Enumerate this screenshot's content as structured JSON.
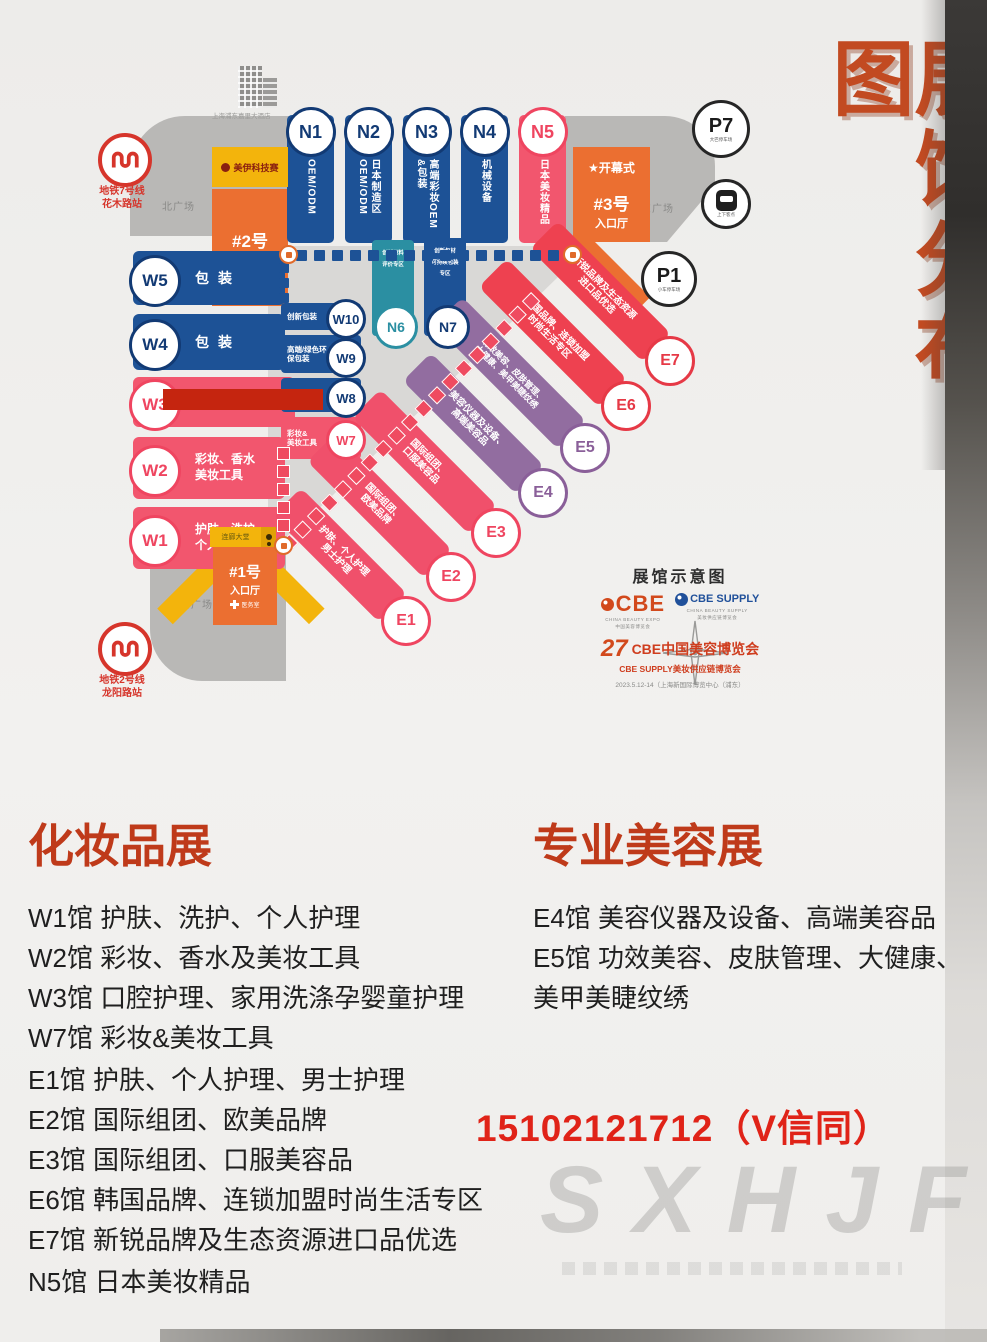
{
  "title": "展馆分布图",
  "colors": {
    "accent_red": "#c24a21",
    "blue": "#1d5296",
    "pink": "#f2566e",
    "red": "#ee4150",
    "purple": "#926da0",
    "orange": "#eb6f31",
    "yellow": "#f3b40c",
    "teal": "#2b8fa2",
    "phone_red": "#e02318",
    "metro_red": "#d6352b"
  },
  "map": {
    "building_caption": "上海浦东嘉里大酒店",
    "metro7": {
      "line": "地铁7号线",
      "station": "花木路站"
    },
    "metro2": {
      "line": "地铁2号线",
      "station": "龙阳路站"
    },
    "plaza_north": "北广场",
    "plaza_east": "东广场",
    "plaza_south": "南广场",
    "science_box": "美伊科技赛",
    "walkway": "连廊大堂",
    "entrance2": {
      "no": "#2号",
      "hall": "入口厅"
    },
    "entrance3": {
      "no": "#3号",
      "hall": "入口厅",
      "ceremony": "★开幕式"
    },
    "entrance1": {
      "no": "#1号",
      "hall": "入口厅",
      "medical": "医务室"
    },
    "p7": {
      "label": "P7",
      "caption": "大巴停车场"
    },
    "p1": {
      "label": "P1",
      "caption": "小车停车场"
    },
    "taxi_caption": "上下客点",
    "n_halls": [
      {
        "id": "N1",
        "col1": "OEM/ODM",
        "col2": ""
      },
      {
        "id": "N2",
        "col1": "日本制造区",
        "col2": "OEM/ODM"
      },
      {
        "id": "N3",
        "col1": "高端彩妆OEM",
        "col2": "&包装"
      },
      {
        "id": "N4",
        "col1": "机械设备",
        "col2": ""
      },
      {
        "id": "N5",
        "col1": "日本美妆精品",
        "col2": ""
      }
    ],
    "n6": {
      "id": "N6",
      "line1": "创新原料",
      "line2": "评价专区",
      "line3": ""
    },
    "n7": {
      "id": "N7",
      "line1": "创新包材",
      "line2": "可持续包装",
      "line3": "专区"
    },
    "w_bars": [
      {
        "id": "W5",
        "text": "包装"
      },
      {
        "id": "W4",
        "text": "包装"
      },
      {
        "id": "W3",
        "text": "口腔护理、家用洗涤"
      },
      {
        "id": "W2",
        "line1": "彩妆、香水",
        "line2": "美妆工具"
      },
      {
        "id": "W1",
        "line1": "护肤、洗护",
        "line2": "个人护理"
      }
    ],
    "w_boxes": [
      {
        "id": "W10",
        "line1": "创新包装",
        "line2": ""
      },
      {
        "id": "W9",
        "line1": "高端/绿色环",
        "line2": "保包装"
      },
      {
        "id": "W8",
        "line1": "",
        "line2": ""
      },
      {
        "id": "W7",
        "line1": "彩妆&",
        "line2": "美妆工具"
      }
    ],
    "e_halls": [
      {
        "id": "E1",
        "line1": "护肤、个人护理",
        "line2": "男士护理"
      },
      {
        "id": "E2",
        "line1": "国际组团、",
        "line2": "欧美品牌"
      },
      {
        "id": "E3",
        "line1": "国际组团、",
        "line2": "口服美容品"
      },
      {
        "id": "E4",
        "line1": "美容仪器及设备、",
        "line2": "高端美容品"
      },
      {
        "id": "E5",
        "line1": "功效美容、皮肤管理、",
        "line2": "大健康、美甲美睫纹绣"
      },
      {
        "id": "E6",
        "line1": "韩国品牌、连锁加盟",
        "line2": "时尚生活专区"
      },
      {
        "id": "E7",
        "line1": "新锐品牌及生态资源",
        "line2": "进口品优选"
      }
    ],
    "legend": {
      "title": "展馆示意图",
      "cbe": "CBE",
      "cbe_en": "CHINA BEAUTY EXPO",
      "cbe_cn": "中国美容博览会",
      "supply_word": "CBE SUPPLY",
      "supply_en": "CHINA BEAUTY SUPPLY",
      "supply_cn": "美妆供应链博览会",
      "num": "27",
      "line1": "CBE中国美容博览会",
      "line2": "CBE SUPPLY美妆供应链博览会",
      "date": "2023.5.12-14（上海新国际博览中心（浦东）"
    }
  },
  "sections": {
    "left": {
      "title": "化妆品展",
      "items": [
        "W1馆 护肤、洗护、个人护理",
        "W2馆 彩妆、香水及美妆工具",
        "W3馆 口腔护理、家用洗涤孕婴童护理",
        "W7馆 彩妆&美妆工具",
        "E1馆 护肤、个人护理、男士护理",
        "E2馆 国际组团、欧美品牌",
        "E3馆 国际组团、口服美容品",
        "E6馆 韩国品牌、连锁加盟时尚生活专区",
        "E7馆 新锐品牌及生态资源进口品优选",
        "N5馆 日本美妆精品"
      ]
    },
    "right": {
      "title": "专业美容展",
      "items": [
        "E4馆 美容仪器及设备、高端美容品",
        "E5馆 功效美容、皮肤管理、大健康、",
        "美甲美睫纹绣"
      ]
    }
  },
  "phone": "15102121712（V信同）",
  "watermark": "SXHJF"
}
